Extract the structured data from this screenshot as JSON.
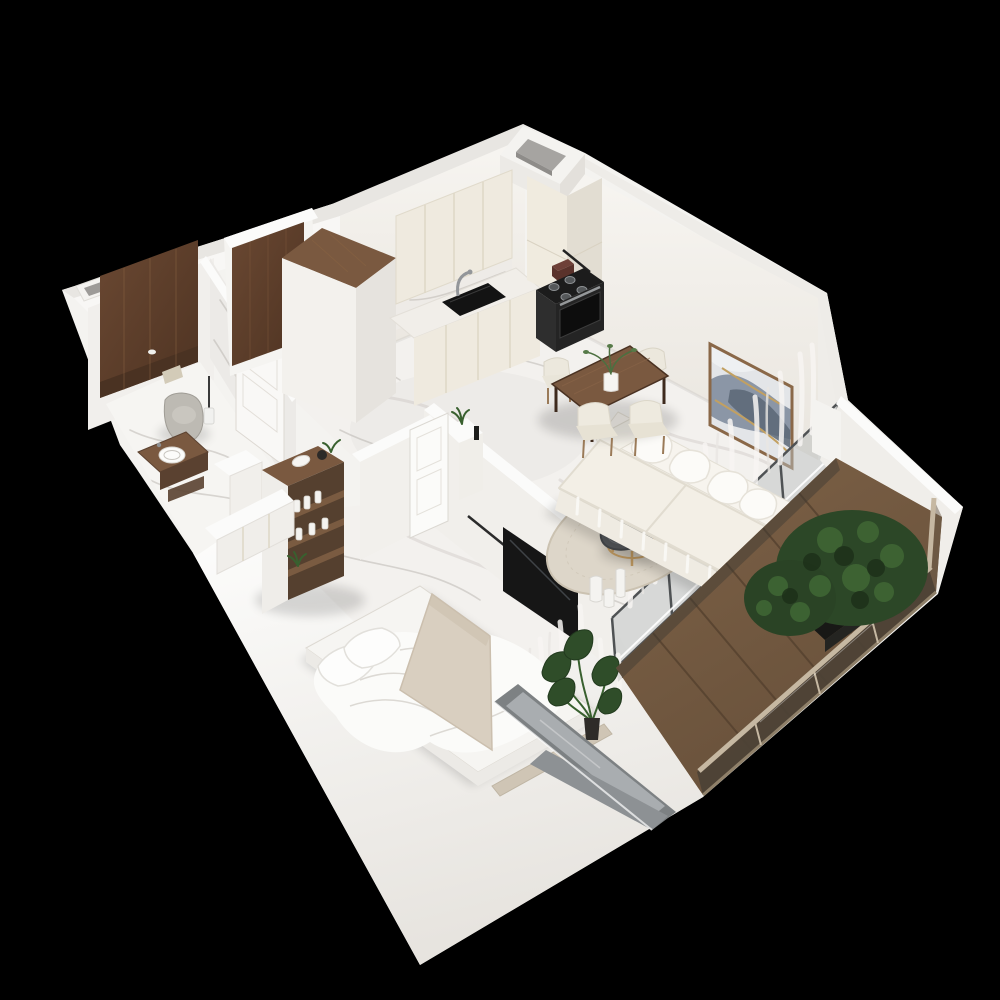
{
  "scene": {
    "type": "isometric-3d-apartment-floor-plan-render",
    "background": "#000000",
    "floor_material": "white-marble",
    "wall_material": "white-plaster"
  },
  "palette": {
    "bg": "#000000",
    "wallBright": "#f4f3f0",
    "wallLight": "#f0eeea",
    "wallMid": "#e8e5e1",
    "wallTop": "#fbfbfa",
    "floor": "#f3f1ee",
    "vein": "#b2ada7",
    "wood": "#7a5940",
    "woodDark": "#5a4130",
    "woodDeep": "#4a3222",
    "cream": "#efeadf",
    "creamDeep": "#e2ddd2",
    "black": "#161616",
    "steel": "#53575a",
    "frameGray": "#7d8183",
    "glass": "#a9adb0",
    "sofa": "#f2eee6",
    "cushion": "#f7f4ee",
    "rug": "#ddd6c9",
    "tableDark": "#54575a",
    "gold": "#b5915c",
    "deckA": "#7e6247",
    "deckB": "#67503a",
    "deckSeam": "#56422f",
    "railGlass": "#4c4236",
    "railTop": "#c6b8a2",
    "leaf": "#2f4d29",
    "shrub": "#2c4727",
    "shrubLight": "#3f6634",
    "toilet": "#bdbab3",
    "blanket": "#d9cfc0",
    "bench": "#cfc5b5",
    "curtain": "#f7f5f2",
    "duvet": "#fbfbf9",
    "artBlue": "#8b96a6",
    "artDark": "#5b6775",
    "artGold": "#c2a061",
    "artFrame": "#8a6848",
    "marbleWall": "#eceae7"
  },
  "rooms": [
    {
      "name": "bathroom",
      "items": [
        "wall-hung-toilet",
        "flush-plate",
        "toilet-brush",
        "walnut-accent-wall",
        "marble-partition-wall",
        "bathroom-door",
        "wood-vanity",
        "vessel-sink",
        "service-shaft"
      ]
    },
    {
      "name": "hallway",
      "items": [
        "entrance-door",
        "walnut-topped-wardrobe",
        "open-shelving-unit",
        "decor-bottles",
        "storage-cabinet",
        "bedroom-door"
      ]
    },
    {
      "name": "kitchen",
      "items": [
        "ventilation-shaft",
        "upper-cabinets",
        "backsplash",
        "counter",
        "sink",
        "faucet",
        "utensil-rail",
        "toaster",
        "gas-cooktop",
        "oven",
        "tall-cabinet-column"
      ]
    },
    {
      "name": "dining-area",
      "chair_count": 4,
      "items": [
        "walnut-dining-table",
        "upholstered-chairs",
        "table-plant"
      ]
    },
    {
      "name": "living-room",
      "items": [
        "three-seat-sofa",
        "throw-pillows",
        "abstract-wall-art",
        "round-coffee-table",
        "area-rug",
        "floor-vases",
        "sheer-curtains",
        "glass-balustrade",
        "tv-panel",
        "tv-partition-wall",
        "console-plant",
        "candle"
      ]
    },
    {
      "name": "bedroom",
      "items": [
        "double-bed",
        "pillows",
        "throw-blanket",
        "foot-bench",
        "built-in-closet",
        "monstera-plant",
        "window",
        "sheer-curtains"
      ]
    },
    {
      "name": "balcony",
      "items": [
        "wood-deck",
        "bronze-glass-railing",
        "planter-box",
        "green-shrubs",
        "sliding-glass-door"
      ]
    }
  ]
}
